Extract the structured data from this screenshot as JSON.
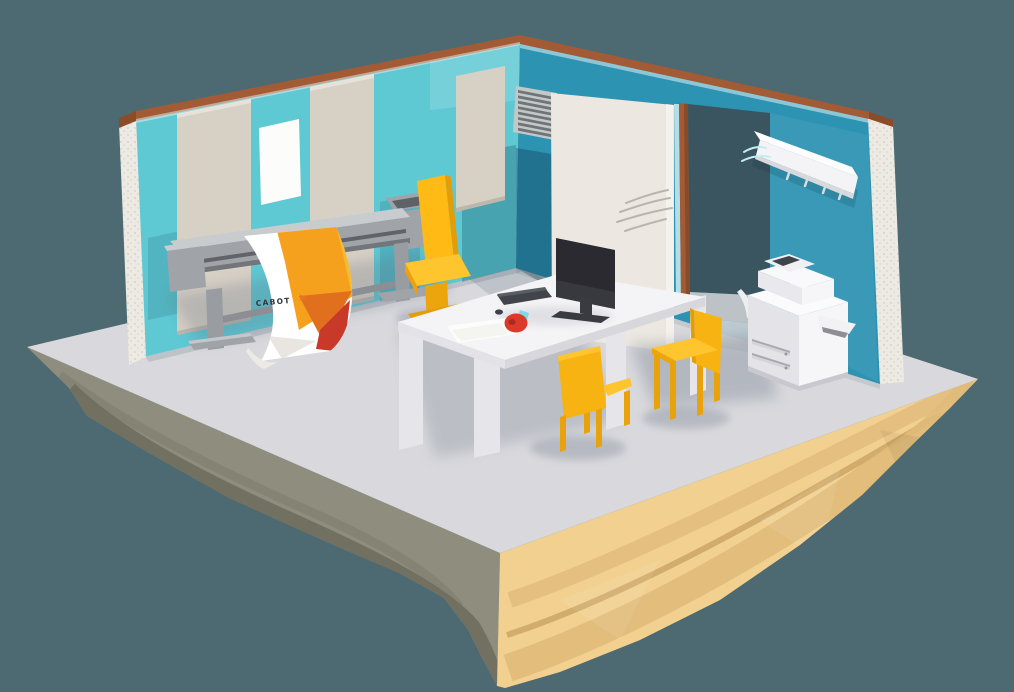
{
  "scene": {
    "description": "Low-poly 3D isometric office room floating on a layered sand island",
    "background_color": "#4d6971"
  },
  "banner": {
    "brand": "CABOT"
  },
  "colors": {
    "bg": "#4d6971",
    "wall_left": "#5ec8d3",
    "wall_right": "#2d93b2",
    "doorway": "#3a555f",
    "copper": "#a25b34",
    "insulation": "#eceae2",
    "panel": "#d7d0c5",
    "paper": "#fcfcfa",
    "door": "#ece8e1",
    "floor": "#d9d9dd",
    "shadow": "#5f6b7d",
    "island_gray": "#8f8d7e",
    "island_gray_dark": "#6f6e5e",
    "sand_light": "#f2d190",
    "sand_mid": "#e0ba7a",
    "sand_dark": "#c9a263",
    "plotter_light": "#c9cccf",
    "plotter_mid": "#a0a4a8",
    "plotter_dark": "#72767b",
    "banner_orange": "#f5a11d",
    "banner_gold": "#f4bb30",
    "banner_deep_orange": "#e0701e",
    "banner_red": "#c8392a",
    "banner_gray": "#e9e6e1",
    "brand_text": "#34343e",
    "brand_chevron": "#e87722",
    "desk_white": "#f4f3f5",
    "desk_side": "#e6e5e9",
    "chair_yellow": "#f7b312",
    "chair_yellow_light": "#ffc52e",
    "chair_yellow_dark": "#e29d0b",
    "monitor": "#2a2a30",
    "monitor_stand": "#3a3b41",
    "keyboard": "#41444a",
    "tape_red": "#dc392b",
    "tape_blue": "#85d6e8",
    "copier_white": "#f6f5f7",
    "copier_shadow": "#e4e3e8",
    "rack_white": "#f4f3f5",
    "vent": "#c3c8c6",
    "vent_dark": "#6e7478",
    "swoosh_gray": "#b9b5ae",
    "swoosh_cyan": "#c2eef4"
  }
}
